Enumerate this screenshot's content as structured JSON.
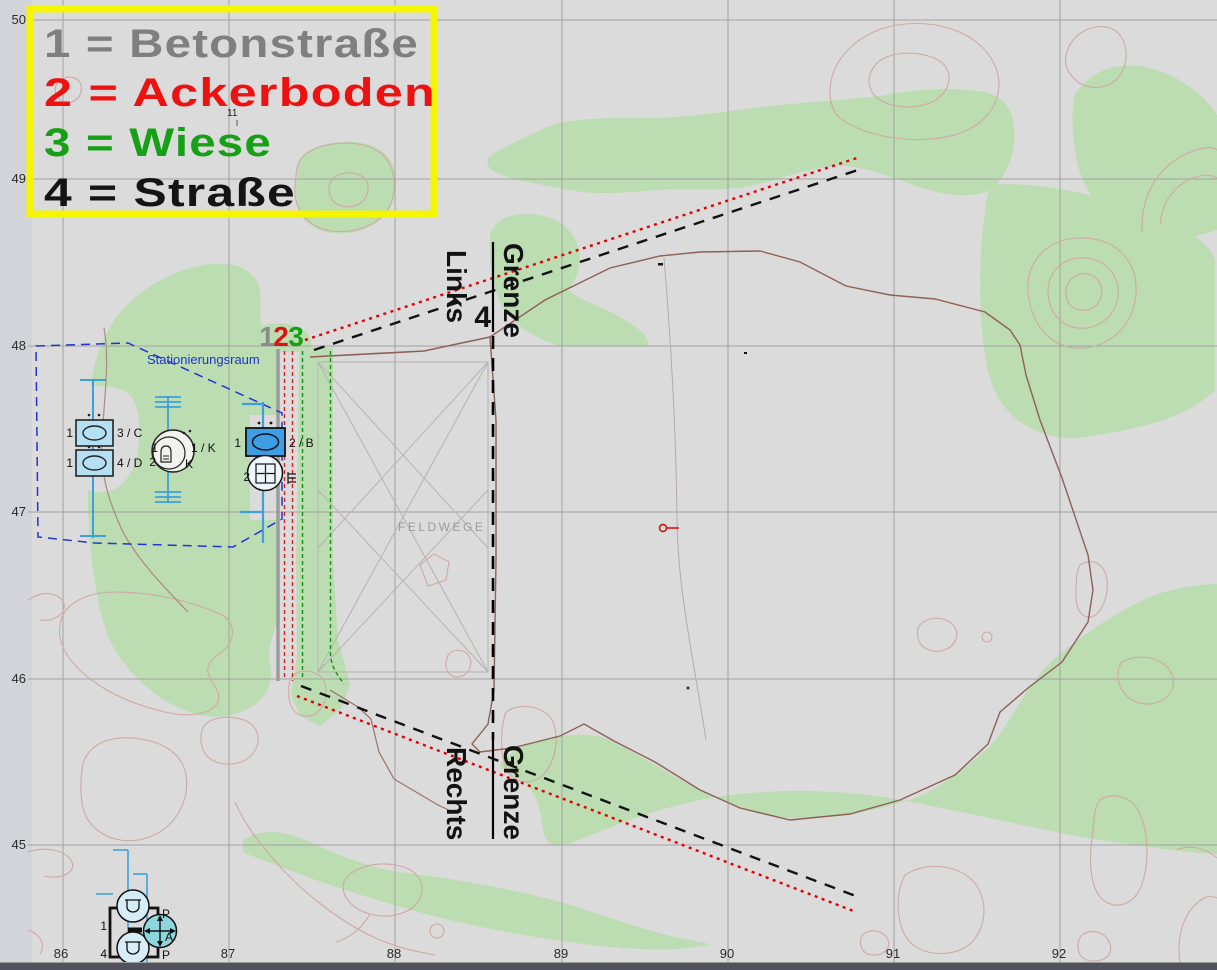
{
  "legend": {
    "border_color": "#f5f500",
    "items": [
      {
        "label": "1 = Betonstraße",
        "color": "#7f7f7f"
      },
      {
        "label": "2 = Ackerboden",
        "color": "#ee1111"
      },
      {
        "label": "3 = Wiese",
        "color": "#16a016"
      },
      {
        "label": "4 = Straße",
        "color": "#141414"
      }
    ]
  },
  "routes": {
    "marker_one": "1",
    "marker_two": "2",
    "marker_three": "3",
    "color_one": "#8a8a8a",
    "color_two": "#dd1111",
    "color_three": "#16a016"
  },
  "boundary": {
    "links": "Links",
    "grenze_top": "Grenze",
    "four": "4",
    "rechts": "Rechts",
    "grenze_bottom": "Grenze"
  },
  "staging_area": {
    "label": "Stationierungsraum"
  },
  "field": {
    "label": "FELDWEGE"
  },
  "map_note": "11",
  "axis": {
    "y": [
      "50",
      "49",
      "48",
      "47",
      "46",
      "45"
    ],
    "x": [
      "86",
      "87",
      "88",
      "89",
      "90",
      "91",
      "92"
    ]
  },
  "units": {
    "left_top": {
      "num": "1",
      "desig": "3 / C"
    },
    "left_bottom": {
      "num": "1",
      "desig": "4 / D"
    },
    "middle": {
      "num1": "1",
      "num2": "2",
      "desig1": "1 / K",
      "desig2": "K"
    },
    "right": {
      "num": "1",
      "desig": "2 / B",
      "num_below": "2"
    },
    "bottom": {
      "num1": "1",
      "num2": "4",
      "p1": "P",
      "a": "A",
      "p2": "P"
    }
  }
}
